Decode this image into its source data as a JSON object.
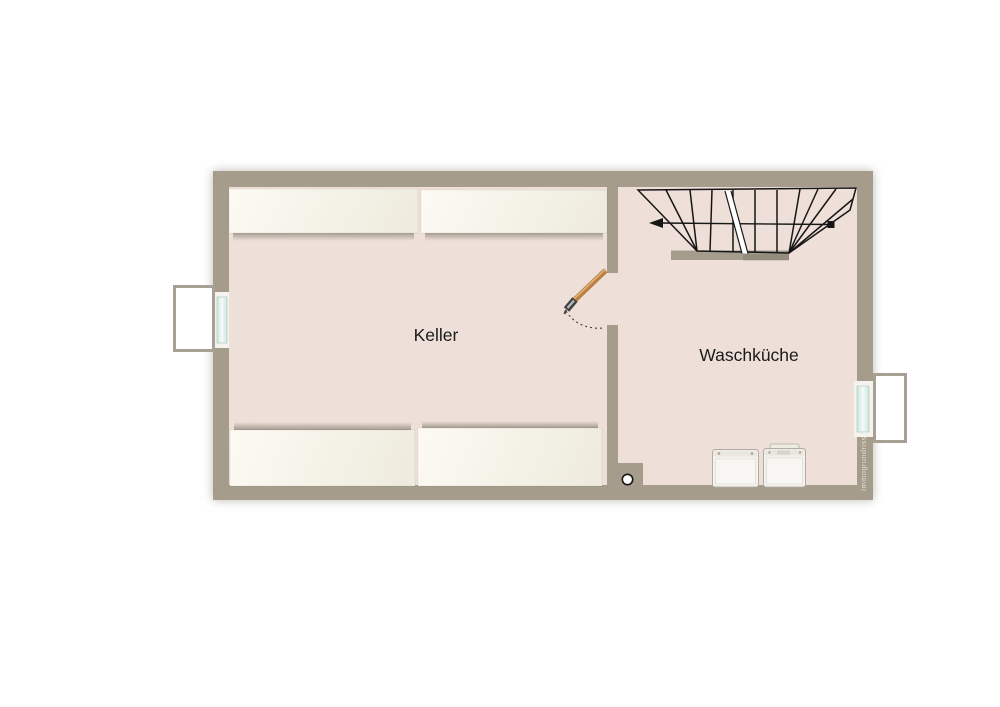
{
  "page": {
    "background": "#ffffff"
  },
  "floorplan": {
    "type": "basement-floor-plan",
    "rooms": [
      {
        "id": "keller",
        "label": "Keller"
      },
      {
        "id": "waschkueche",
        "label": "Waschküche"
      }
    ],
    "watermark": "Immogrundriss",
    "features": {
      "stairs": "winder-staircase-top-right",
      "door": "wood-door-between-keller-and-waschkueche",
      "windows": [
        "left-basement-window-with-light-shaft",
        "right-basement-window-with-light-shaft"
      ],
      "appliances": [
        "washing-machine",
        "washing-machine"
      ],
      "shelving_units": 4,
      "drain": "round-floor-drain"
    },
    "colors": {
      "wall": "#a59c8b",
      "floor": "#eee0d8",
      "line": "#161616",
      "door_wood": "#b97f43",
      "window_glass": "#d6eae3",
      "shelf": "#f7f4ea",
      "appliance": "#f3f2ee",
      "watermark_text": "#e8e3d9"
    }
  }
}
